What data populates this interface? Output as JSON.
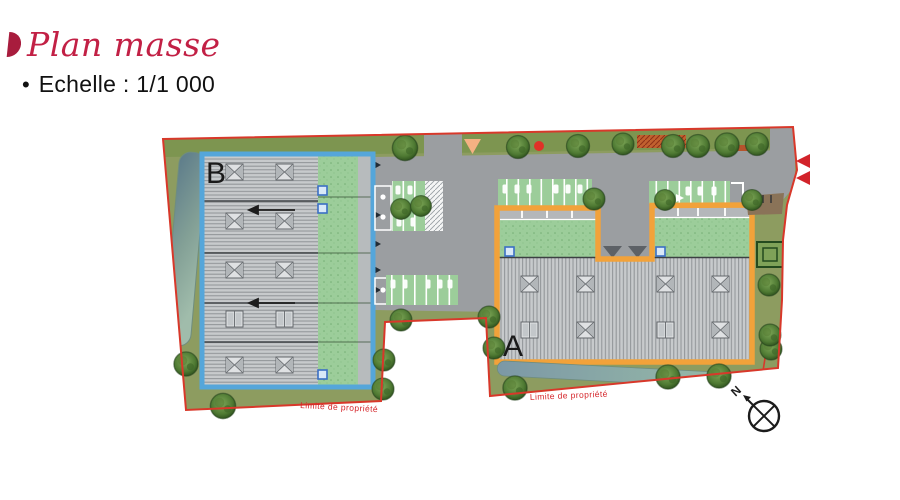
{
  "header": {
    "title": "Plan masse",
    "scale_bullet": "•",
    "scale_label": "Echelle : 1/1 000"
  },
  "plan": {
    "building_a_label": "A",
    "building_b_label": "B",
    "boundary_label_left": "Limite de propriété",
    "boundary_label_right": "Limite de propriété",
    "compass_north_label": "N"
  },
  "colors": {
    "title_red": "#c22045",
    "boundary_red": "#d8382a",
    "building_a_outline": "#f2a23a",
    "building_b_outline": "#55a6da",
    "lawn_green": "#8d9c60",
    "parking_green": "#9ccd9a",
    "road_gray": "#9b9ea1",
    "water_blue": "#7f9dab",
    "label_red": "#d5252a"
  }
}
